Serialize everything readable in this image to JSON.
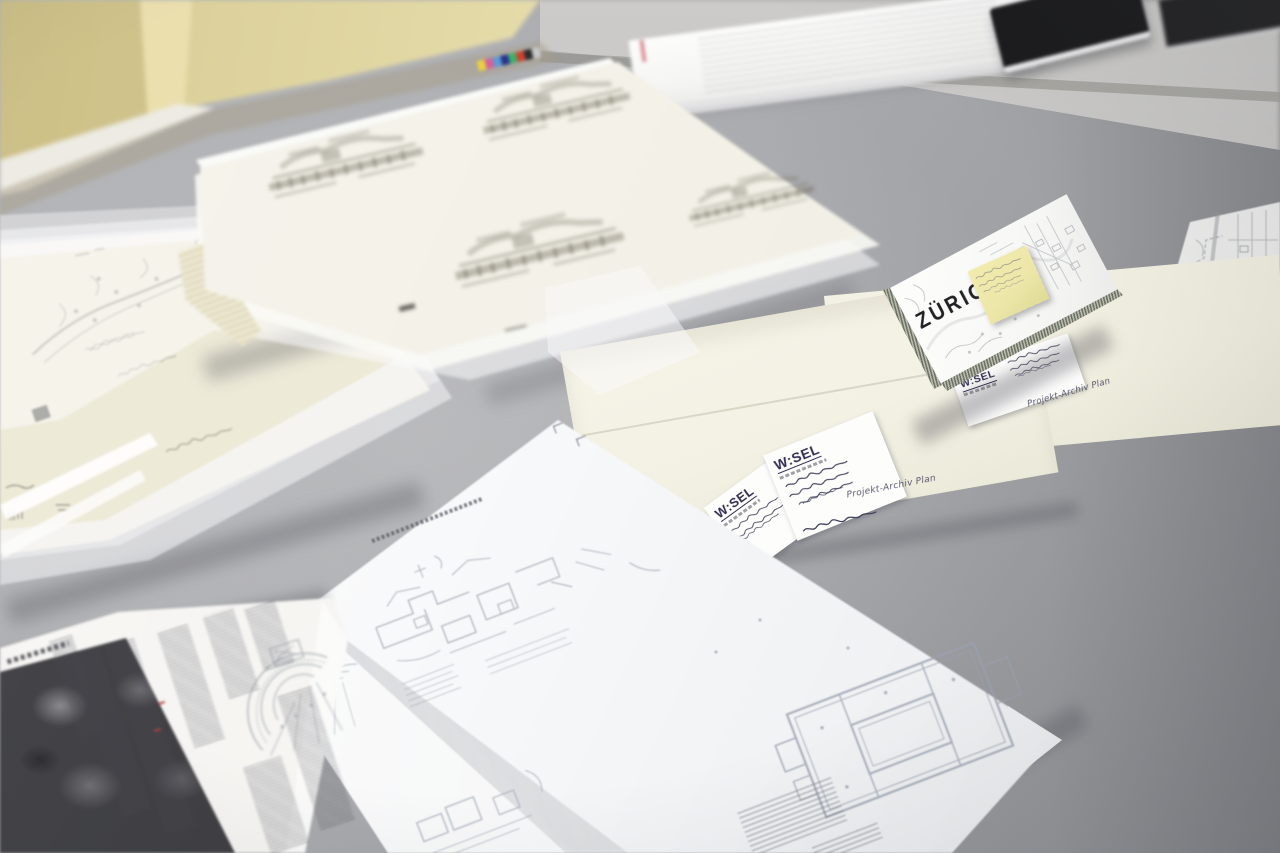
{
  "zurich_map": {
    "title": "ZÜRICH"
  },
  "wesel_label": {
    "brand": "W:SEL"
  },
  "envelopes": {
    "note_front": "Projekt-Archiv Plan",
    "note_right": "Projekt-Archiv Plan"
  },
  "color_calibration_bar": [
    "#e8d23e",
    "#d75f9a",
    "#5a9bd5",
    "#27348b",
    "#3fae6a",
    "#d0402f",
    "#2b2b2b",
    "#c8c8c8"
  ],
  "colors": {
    "table_gray": "#a9aaad",
    "table_shadow": "#8f9094",
    "table_highlight": "#c9c8c6",
    "wall_yellow": "#e2d8a4",
    "window_sill_white": "#edebe3",
    "tracing_paper": "#f4f2e9",
    "sketch_graphite": "#6e6959",
    "envelope_cream": "#f4f2e5",
    "label_white": "#fdfdfc",
    "brand_ink": "#332e52",
    "handwriting_ink": "#3a3a55",
    "pencil_gray": "#8a877c",
    "postit_yellow": "#ece7a9",
    "map_line_gray": "#9aa0a8",
    "plan_line_gray": "#a6adb9",
    "red_annotation": "#b5413f",
    "halftone_dark": "#46464a",
    "notebook_black": "#1b1b1d"
  }
}
